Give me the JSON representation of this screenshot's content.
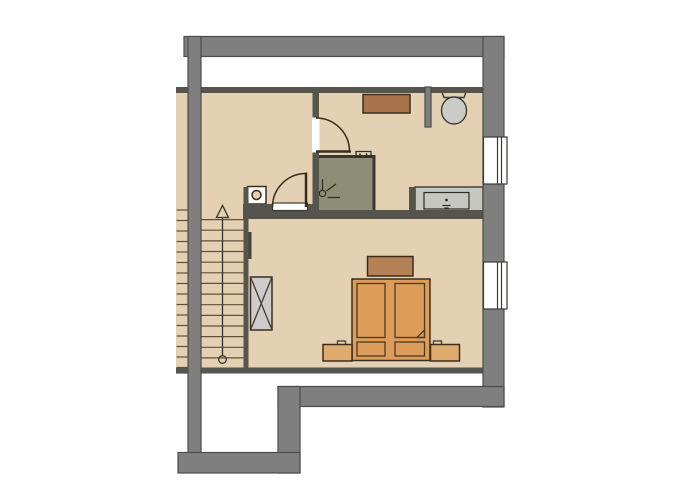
{
  "plan": {
    "kind": "floor-plan",
    "rooms": [
      "hallway-landing",
      "bathroom",
      "bedroom",
      "staircase"
    ],
    "low_headroom_strip": "white strip along top wall",
    "windows_count": 2,
    "doors_count": 2
  },
  "stairs": {
    "main_flight_treads": 14,
    "side_flight_treads": 16,
    "direction": "up"
  },
  "icons": {
    "stairs_arrow": "up-arrow with start circle",
    "chimney": "square with circle",
    "shower_head": "circle with spray lines",
    "wardrobe_cross": "X-crossed rectangle",
    "washbasin_drain": "dot with trap lines"
  },
  "colors": {
    "background": "#ffffff",
    "white": "#ffffff",
    "floor": "#e4d0b3",
    "outer_wall": "#7f7f7f",
    "inner_wall": "#55544d",
    "wardrobe": "#cccccc",
    "shower": "#8e8e76",
    "counter": "#c6c6c3",
    "counter_basin": "#dadad6",
    "toilet": "#cbcbc9",
    "cabinet": "#a8734b",
    "bed": "#dd9d59",
    "headboard": "#b48157",
    "nightstand": "#dfab6c",
    "dogear": "#eccfa6",
    "radiator": "#4a453c",
    "chimney_box": "#ffffff"
  }
}
